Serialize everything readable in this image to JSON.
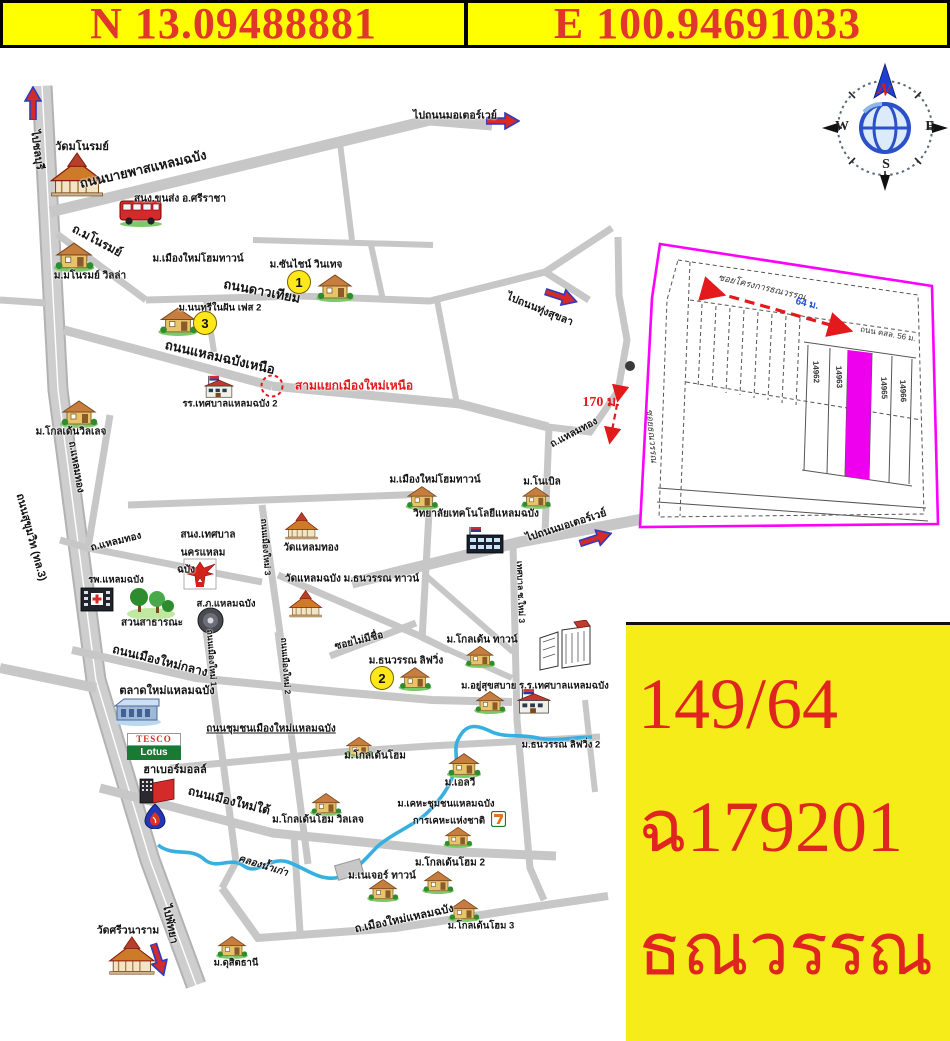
{
  "header": {
    "north": "N 13.09488881",
    "east": "E 100.94691033"
  },
  "compass": {
    "n": "N",
    "e": "E",
    "s": "S",
    "w": "W"
  },
  "map": {
    "tesco": {
      "top": "TESCO",
      "bottom": "Lotus"
    },
    "labels": [
      {
        "t": "ไปชลบุรี",
        "x": 38,
        "y": 150,
        "r": 82,
        "s": 11
      },
      {
        "t": "วัดมโนรมย์",
        "x": 82,
        "y": 146,
        "s": 11
      },
      {
        "t": "ถนนบายพาสแหลมฉบัง",
        "x": 143,
        "y": 169,
        "r": -13,
        "s": 13
      },
      {
        "t": "สนง.ขนส่ง อ.ศรีราชา",
        "x": 180,
        "y": 199,
        "s": 10
      },
      {
        "t": "ถ.มโนรมย์",
        "x": 97,
        "y": 241,
        "r": 28,
        "s": 12
      },
      {
        "t": "ม.เมืองใหม่โฮมทาวน์",
        "x": 198,
        "y": 259,
        "s": 10
      },
      {
        "t": "ม.มโนรมย์ วิลล่า",
        "x": 90,
        "y": 276,
        "s": 10
      },
      {
        "t": "ม.ซันไชน์ วินเทจ",
        "x": 306,
        "y": 265,
        "s": 10
      },
      {
        "t": "ถนนดาวเทียม",
        "x": 262,
        "y": 291,
        "r": 11,
        "s": 13
      },
      {
        "t": "ม.นนทรีในฝัน เฟส 2",
        "x": 220,
        "y": 308,
        "s": 9.5
      },
      {
        "t": "ไปถนนมอเตอร์เวย์",
        "x": 455,
        "y": 115,
        "s": 10.5
      },
      {
        "t": "ไปถนนทุ่งสุขลา",
        "x": 540,
        "y": 309,
        "r": 22,
        "s": 10.5
      },
      {
        "t": "ถนนแหลมฉบังเหนือ",
        "x": 220,
        "y": 357,
        "r": 13,
        "s": 13
      },
      {
        "t": "รร.เทศบาลแหลมฉบัง 2",
        "x": 230,
        "y": 404,
        "s": 9.5
      },
      {
        "t": "สามแยกเมืองใหม่เหนือ",
        "x": 354,
        "y": 386,
        "s": 12,
        "c": "red"
      },
      {
        "t": "ม.โกลเด้นวิลเลจ",
        "x": 71,
        "y": 432,
        "s": 10
      },
      {
        "t": "ถ.แหลมทอง",
        "x": 76,
        "y": 467,
        "r": 80,
        "s": 10
      },
      {
        "t": "ถนนสุขุมวิท (ทล.3)",
        "x": 32,
        "y": 537,
        "r": 75,
        "s": 11
      },
      {
        "t": "ถ.แหลมทอง",
        "x": 116,
        "y": 542,
        "r": -14,
        "s": 10
      },
      {
        "t": "ถ.แหลมทอง",
        "x": 574,
        "y": 433,
        "r": -28,
        "s": 10
      },
      {
        "t": "ม.เมืองใหม่โฮมทาวน์",
        "x": 435,
        "y": 480,
        "s": 10
      },
      {
        "t": "ม.โนเบิล",
        "x": 542,
        "y": 482,
        "s": 10
      },
      {
        "t": "วิทยาลัยเทคโนโลยีแหลมฉบัง",
        "x": 476,
        "y": 514,
        "s": 10
      },
      {
        "t": "ไปถนนมอเตอร์เวย์",
        "x": 566,
        "y": 525,
        "r": -18,
        "s": 10.5
      },
      {
        "t": "สนง.เทศบาล",
        "x": 208,
        "y": 535,
        "s": 10
      },
      {
        "t": "นครแหลม",
        "x": 203,
        "y": 553,
        "s": 10
      },
      {
        "t": "ฉบัง",
        "x": 186,
        "y": 570,
        "s": 10
      },
      {
        "t": "วัดแหลมทอง",
        "x": 311,
        "y": 548,
        "s": 10
      },
      {
        "t": "วัดแหลมฉบัง ม.ธนวรรณ ทาวน์",
        "x": 352,
        "y": 579,
        "s": 10
      },
      {
        "t": "ถนนเมืองใหม่ 3",
        "x": 266,
        "y": 547,
        "r": 86,
        "s": 8.5
      },
      {
        "t": "ส.ภ.แหลมฉบัง",
        "x": 226,
        "y": 604,
        "s": 9.5
      },
      {
        "t": "สวนสาธารณะ",
        "x": 152,
        "y": 623,
        "s": 10
      },
      {
        "t": "รพ.แหลมฉบัง",
        "x": 116,
        "y": 580,
        "s": 9.5
      },
      {
        "t": "ถนนเมืองใหม่กลาง",
        "x": 160,
        "y": 661,
        "r": 14,
        "s": 12
      },
      {
        "t": "ถนนเมืองใหม่ 1",
        "x": 212,
        "y": 658,
        "r": 86,
        "s": 8.5
      },
      {
        "t": "ถนนเมืองใหม่ 2",
        "x": 286,
        "y": 666,
        "r": 86,
        "s": 8.5
      },
      {
        "t": "เทศบาล ซ.ใหม่ 3",
        "x": 521,
        "y": 592,
        "r": 88,
        "s": 8.5
      },
      {
        "t": "ตลาดใหม่แหลมฉบัง",
        "x": 167,
        "y": 690,
        "s": 11
      },
      {
        "t": "ถนนชุมชนเมืองใหม่แหลมฉบัง",
        "x": 271,
        "y": 729,
        "s": 10,
        "u": 1
      },
      {
        "t": "ฮาเบอร์มอลล์",
        "x": 175,
        "y": 769,
        "s": 11
      },
      {
        "t": "ถนนเมืองใหม่ใต้",
        "x": 229,
        "y": 801,
        "r": 14,
        "s": 12
      },
      {
        "t": "ซอยไม่มีชื่อ",
        "x": 359,
        "y": 641,
        "r": -14,
        "s": 10
      },
      {
        "t": "ม.ธนวรรณ ลิฟวิ่ง",
        "x": 406,
        "y": 661,
        "s": 10
      },
      {
        "t": "ม.โกลเด้น ทาวน์",
        "x": 482,
        "y": 640,
        "s": 10
      },
      {
        "t": "ม.อยู่สุขสบาย ร.ร.เทศบาลแหลมฉบัง",
        "x": 535,
        "y": 686,
        "s": 9.5
      },
      {
        "t": "ม.ธนวรรณ ลิฟวิ่ง 2",
        "x": 561,
        "y": 745,
        "s": 9.5
      },
      {
        "t": "ม.โกลเด้นโฮม",
        "x": 375,
        "y": 756,
        "s": 10
      },
      {
        "t": "ม.เอลวี",
        "x": 460,
        "y": 783,
        "s": 10
      },
      {
        "t": "ม.เคหะชุมชนแหลมฉบัง",
        "x": 446,
        "y": 804,
        "s": 9.5
      },
      {
        "t": "การเคหะแห่งชาติ",
        "x": 449,
        "y": 821,
        "s": 9.5
      },
      {
        "t": "คลองน้ำเก่า",
        "x": 263,
        "y": 866,
        "r": 17,
        "s": 10,
        "i": 1
      },
      {
        "t": "ม.โกลเด้นโฮม วิลเลจ",
        "x": 318,
        "y": 820,
        "s": 10
      },
      {
        "t": "ม.เนเจอร์ ทาวน์",
        "x": 382,
        "y": 876,
        "s": 10
      },
      {
        "t": "ม.โกลเด้นโฮม 2",
        "x": 450,
        "y": 863,
        "s": 10
      },
      {
        "t": "ถ.เมืองใหม่แหลมฉบัง",
        "x": 404,
        "y": 918,
        "r": -12,
        "s": 11
      },
      {
        "t": "ม.โกลเด้นโฮม 3",
        "x": 481,
        "y": 926,
        "s": 9.5
      },
      {
        "t": "วัดศรีวนาราม",
        "x": 128,
        "y": 930,
        "s": 10.5
      },
      {
        "t": "ไปพัทยา",
        "x": 171,
        "y": 924,
        "r": 78,
        "s": 11
      },
      {
        "t": "ม.ดุสิตธานี",
        "x": 236,
        "y": 963,
        "s": 9.5
      }
    ],
    "markers": [
      {
        "n": "1",
        "x": 299,
        "y": 282
      },
      {
        "n": "3",
        "x": 205,
        "y": 323
      },
      {
        "n": "2",
        "x": 382,
        "y": 678
      }
    ],
    "icons": [
      {
        "k": "temple",
        "x": 45,
        "y": 152,
        "w": 62,
        "h": 46
      },
      {
        "k": "bus",
        "x": 118,
        "y": 197,
        "w": 46,
        "h": 30
      },
      {
        "k": "house",
        "x": 52,
        "y": 240,
        "w": 44,
        "h": 32
      },
      {
        "k": "house",
        "x": 314,
        "y": 272,
        "w": 42,
        "h": 30
      },
      {
        "k": "house",
        "x": 156,
        "y": 305,
        "w": 44,
        "h": 31
      },
      {
        "k": "school",
        "x": 203,
        "y": 375,
        "w": 32,
        "h": 24
      },
      {
        "k": "house",
        "x": 58,
        "y": 398,
        "w": 42,
        "h": 30
      },
      {
        "k": "house",
        "x": 404,
        "y": 484,
        "w": 36,
        "h": 26
      },
      {
        "k": "house",
        "x": 519,
        "y": 485,
        "w": 34,
        "h": 24
      },
      {
        "k": "college",
        "x": 465,
        "y": 527,
        "w": 40,
        "h": 28
      },
      {
        "k": "temple",
        "x": 282,
        "y": 509,
        "w": 38,
        "h": 34
      },
      {
        "k": "temple",
        "x": 286,
        "y": 586,
        "w": 38,
        "h": 36
      },
      {
        "k": "garuda",
        "x": 183,
        "y": 558,
        "w": 34,
        "h": 32
      },
      {
        "k": "police",
        "x": 197,
        "y": 607,
        "w": 27,
        "h": 27
      },
      {
        "k": "trees",
        "x": 126,
        "y": 584,
        "w": 50,
        "h": 36
      },
      {
        "k": "hospital",
        "x": 79,
        "y": 585,
        "w": 36,
        "h": 28
      },
      {
        "k": "market",
        "x": 114,
        "y": 696,
        "w": 48,
        "h": 30
      },
      {
        "k": "mall",
        "x": 138,
        "y": 777,
        "w": 38,
        "h": 28
      },
      {
        "k": "ptt",
        "x": 144,
        "y": 803,
        "w": 22,
        "h": 26
      },
      {
        "k": "house",
        "x": 396,
        "y": 665,
        "w": 38,
        "h": 26
      },
      {
        "k": "house",
        "x": 460,
        "y": 644,
        "w": 40,
        "h": 24
      },
      {
        "k": "house",
        "x": 472,
        "y": 689,
        "w": 36,
        "h": 25
      },
      {
        "k": "school",
        "x": 516,
        "y": 688,
        "w": 36,
        "h": 27
      },
      {
        "k": "factory",
        "x": 538,
        "y": 620,
        "w": 58,
        "h": 52
      },
      {
        "k": "house",
        "x": 341,
        "y": 735,
        "w": 36,
        "h": 23
      },
      {
        "k": "house",
        "x": 446,
        "y": 751,
        "w": 36,
        "h": 27
      },
      {
        "k": "house",
        "x": 439,
        "y": 825,
        "w": 38,
        "h": 23
      },
      {
        "k": "seven",
        "x": 491,
        "y": 811,
        "w": 15,
        "h": 16
      },
      {
        "k": "house",
        "x": 307,
        "y": 791,
        "w": 38,
        "h": 25
      },
      {
        "k": "house",
        "x": 362,
        "y": 877,
        "w": 42,
        "h": 25
      },
      {
        "k": "house",
        "x": 419,
        "y": 869,
        "w": 38,
        "h": 25
      },
      {
        "k": "house",
        "x": 444,
        "y": 897,
        "w": 40,
        "h": 25
      },
      {
        "k": "temple",
        "x": 99,
        "y": 936,
        "w": 64,
        "h": 40
      },
      {
        "k": "house",
        "x": 214,
        "y": 934,
        "w": 36,
        "h": 25
      }
    ]
  },
  "plot_diagram": {
    "soi_project_label": "ซอยโครงการธณวรรณ",
    "soi_length": "64 ม.",
    "road_note": "ถนน คสล. 56 ม.",
    "side_soi": "ซอยธณวรรณ",
    "distance_note": "170 ม.",
    "plot_numbers": [
      "14962",
      "14963",
      "14965",
      "14966"
    ]
  },
  "info_box": {
    "line1": "149/64",
    "line2": "ฉ179201",
    "line3": "ธณวรรณ"
  },
  "colors": {
    "banner_bg": "#ffff00",
    "banner_text": "#e0362b",
    "info_bg": "#f6ec19",
    "info_text": "#e02520",
    "road": "#c7c7c7",
    "stream": "#35b0e0",
    "plot_outline": "#ff00ff",
    "plot_highlight": "#ee00ee",
    "red_accent": "#e31a1c"
  }
}
